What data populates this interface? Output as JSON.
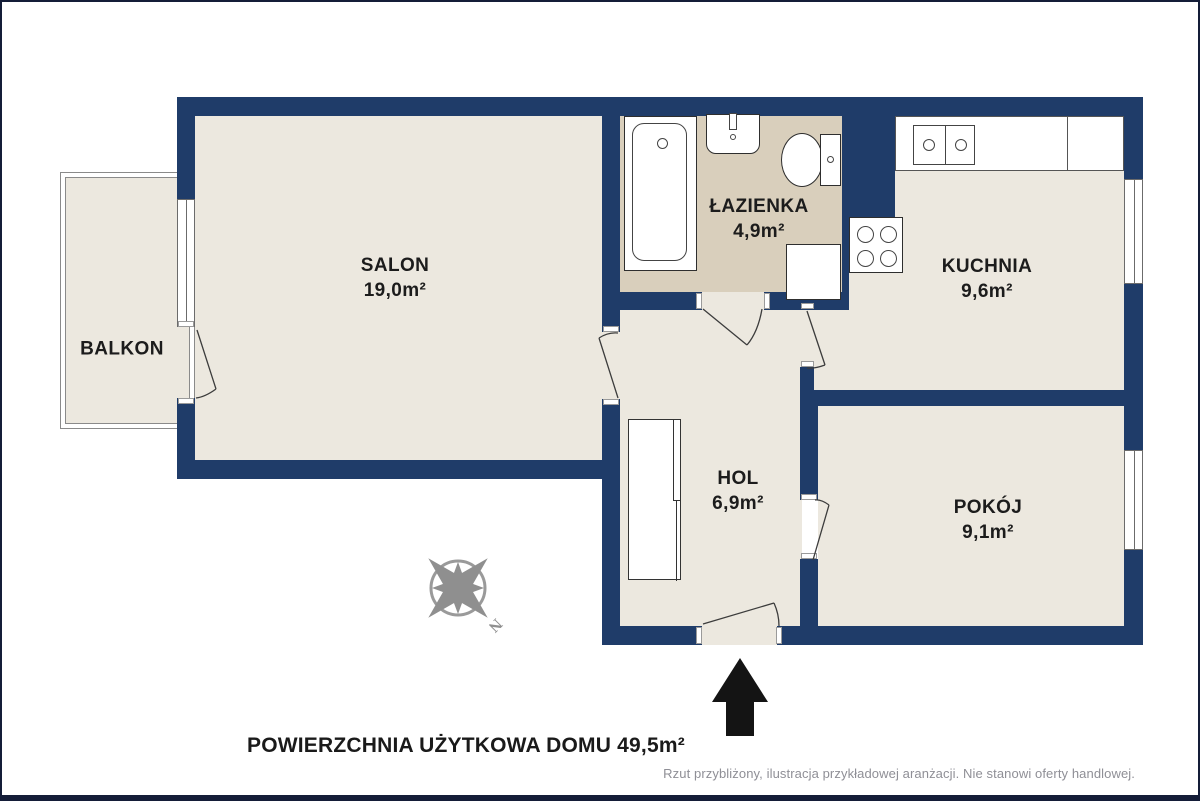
{
  "rooms": {
    "salon": {
      "name": "SALON",
      "area": "19,0m²"
    },
    "lazienka": {
      "name": "ŁAZIENKA",
      "area": "4,9m²"
    },
    "kuchnia": {
      "name": "KUCHNIA",
      "area": "9,6m²"
    },
    "hol": {
      "name": "HOL",
      "area": "6,9m²"
    },
    "pokoj": {
      "name": "POKÓJ",
      "area": "9,1m²"
    },
    "balkon": {
      "name": "BALKON"
    }
  },
  "compass": {
    "north_label": "N"
  },
  "footer": {
    "total_area": "POWIERZCHNIA UŻYTKOWA DOMU 49,5m²",
    "disclaimer": "Rzut przybliżony, ilustracja przykładowej aranżacji. Nie stanowi oferty handlowej."
  },
  "colors": {
    "wall": "#1f3c69",
    "floor": "#ece8df",
    "bath-floor": "#d9cfbc",
    "outline": "#3a3a3a",
    "muted": "#8f8f96",
    "frame": "#141d38"
  }
}
